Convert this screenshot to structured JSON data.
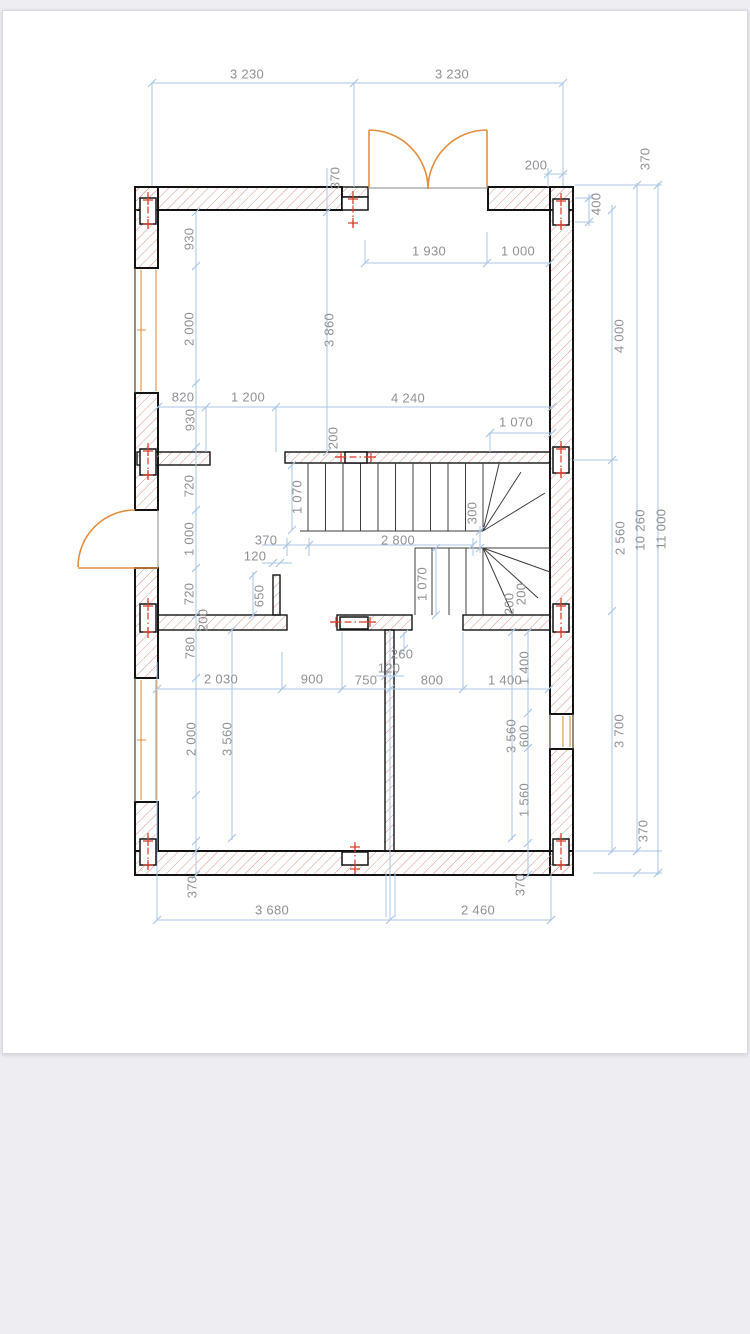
{
  "page": {
    "kind_label": "floor-plan-sheet"
  },
  "drawing": {
    "colors": {
      "dim_line": "#a9c6e5",
      "dim_text": "#8f9194",
      "wall_outline": "#141414",
      "wall_hatch": "#db958c",
      "door_orange": "#e28f3e",
      "axis_red": "#d93a2b",
      "stair_line": "#3d3d3d",
      "canvas_bg": "#ededf2",
      "page_bg": "#ffffff",
      "card_border": "#d8dade"
    },
    "dimension_labels": [
      {
        "text": "3 230",
        "x": 247,
        "y": 75,
        "rot": 0
      },
      {
        "text": "3 230",
        "x": 452,
        "y": 75,
        "rot": 0
      },
      {
        "text": "1 930",
        "x": 429,
        "y": 252,
        "rot": 0
      },
      {
        "text": "1 000",
        "x": 518,
        "y": 252,
        "rot": 0
      },
      {
        "text": "200",
        "x": 536,
        "y": 166,
        "rot": 0
      },
      {
        "text": "820",
        "x": 183,
        "y": 398,
        "rot": 0
      },
      {
        "text": "1 200",
        "x": 248,
        "y": 398,
        "rot": 0
      },
      {
        "text": "4 240",
        "x": 408,
        "y": 399,
        "rot": 0
      },
      {
        "text": "1 070",
        "x": 516,
        "y": 423,
        "rot": 0
      },
      {
        "text": "370",
        "x": 266,
        "y": 541,
        "rot": 0
      },
      {
        "text": "2 800",
        "x": 398,
        "y": 541,
        "rot": 0
      },
      {
        "text": "120",
        "x": 255,
        "y": 557,
        "rot": 0
      },
      {
        "text": "260",
        "x": 402,
        "y": 655,
        "rot": 0
      },
      {
        "text": "120",
        "x": 389,
        "y": 669,
        "rot": 0
      },
      {
        "text": "2 030",
        "x": 221,
        "y": 680,
        "rot": 0
      },
      {
        "text": "900",
        "x": 312,
        "y": 680,
        "rot": 0
      },
      {
        "text": "750",
        "x": 366,
        "y": 681,
        "rot": 0
      },
      {
        "text": "800",
        "x": 432,
        "y": 681,
        "rot": 0
      },
      {
        "text": "1 400",
        "x": 505,
        "y": 681,
        "rot": 0
      },
      {
        "text": "3 680",
        "x": 272,
        "y": 911,
        "rot": 0
      },
      {
        "text": "2 460",
        "x": 478,
        "y": 911,
        "rot": 0
      },
      {
        "text": "370",
        "x": 336,
        "y": 178,
        "rot": -90
      },
      {
        "text": "370",
        "x": 646,
        "y": 159,
        "rot": -90
      },
      {
        "text": "400",
        "x": 597,
        "y": 204,
        "rot": -90
      },
      {
        "text": "930",
        "x": 190,
        "y": 239,
        "rot": -90
      },
      {
        "text": "2 000",
        "x": 190,
        "y": 329,
        "rot": -90
      },
      {
        "text": "3 860",
        "x": 330,
        "y": 330,
        "rot": -90
      },
      {
        "text": "930",
        "x": 191,
        "y": 420,
        "rot": -90
      },
      {
        "text": "4 000",
        "x": 620,
        "y": 336,
        "rot": -90
      },
      {
        "text": "2 560",
        "x": 621,
        "y": 538,
        "rot": -90
      },
      {
        "text": "10 260",
        "x": 641,
        "y": 530,
        "rot": -90
      },
      {
        "text": "11 000",
        "x": 662,
        "y": 529,
        "rot": -90
      },
      {
        "text": "1 070",
        "x": 298,
        "y": 497,
        "rot": -90
      },
      {
        "text": "300",
        "x": 473,
        "y": 513,
        "rot": -90
      },
      {
        "text": "200",
        "x": 334,
        "y": 438,
        "rot": -90
      },
      {
        "text": "720",
        "x": 190,
        "y": 486,
        "rot": -90
      },
      {
        "text": "1 000",
        "x": 190,
        "y": 539,
        "rot": -90
      },
      {
        "text": "720",
        "x": 190,
        "y": 594,
        "rot": -90
      },
      {
        "text": "650",
        "x": 260,
        "y": 596,
        "rot": -90
      },
      {
        "text": "200",
        "x": 204,
        "y": 620,
        "rot": -90
      },
      {
        "text": "1 070",
        "x": 423,
        "y": 584,
        "rot": -90
      },
      {
        "text": "200",
        "x": 510,
        "y": 604,
        "rot": -90
      },
      {
        "text": "200",
        "x": 522,
        "y": 594,
        "rot": -90
      },
      {
        "text": "780",
        "x": 191,
        "y": 648,
        "rot": -90
      },
      {
        "text": "2 000",
        "x": 192,
        "y": 739,
        "rot": -90
      },
      {
        "text": "3 560",
        "x": 228,
        "y": 739,
        "rot": -90
      },
      {
        "text": "3 560",
        "x": 512,
        "y": 736,
        "rot": -90
      },
      {
        "text": "1 400",
        "x": 525,
        "y": 668,
        "rot": -90
      },
      {
        "text": "600",
        "x": 525,
        "y": 736,
        "rot": -90
      },
      {
        "text": "1 560",
        "x": 525,
        "y": 800,
        "rot": -90
      },
      {
        "text": "3 700",
        "x": 620,
        "y": 731,
        "rot": -90
      },
      {
        "text": "370",
        "x": 644,
        "y": 831,
        "rot": -90
      },
      {
        "text": "370",
        "x": 521,
        "y": 885,
        "rot": -90
      },
      {
        "text": "370",
        "x": 193,
        "y": 887,
        "rot": -90
      }
    ]
  }
}
